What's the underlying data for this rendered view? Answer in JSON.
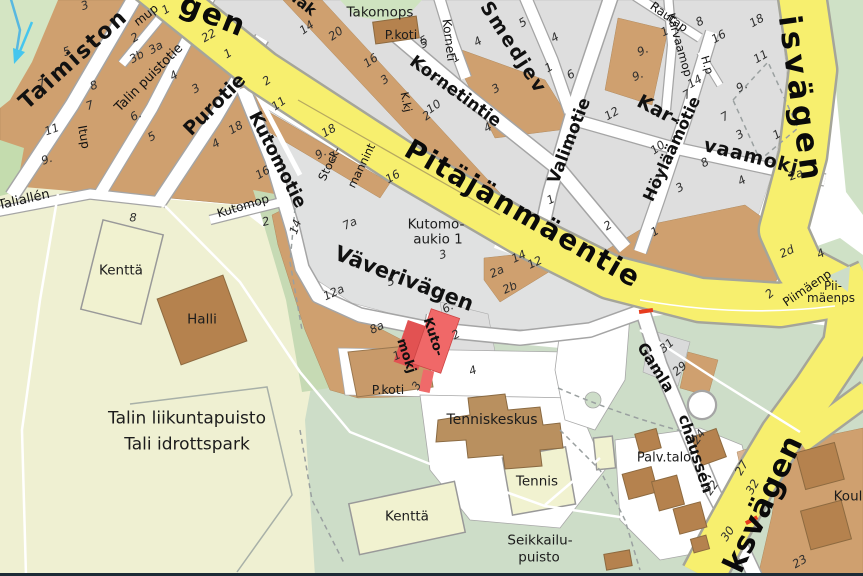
{
  "map": {
    "description": "Street map of Pitajanmaki / Tali area with highlighted street",
    "highlight": {
      "street": "Kutomokj",
      "lines": [
        "Kuto-",
        "mokj"
      ],
      "color": "#ef6363"
    },
    "colors": {
      "main_road_yellow": "#f7ef6e",
      "road_casing": "#a5a5a5",
      "block_tan": "#cfa06f",
      "block_gray": "#dedede",
      "building_brown": "#b5824e",
      "park_pale": "#eff0d2",
      "park_green": "#cdddc8",
      "park_nw": "#d4e5c3",
      "field_fill": "#f1f2d0",
      "highlight_red": "#ef6363",
      "road_mark_red": "#e73c1e",
      "water_blue": "#58b8e0"
    },
    "labels": [
      {
        "k": "road",
        "n": "road-label-fragment-gen",
        "t": "gen",
        "x": 213,
        "y": 16,
        "r": 22,
        "s": 30,
        "ls": 2
      },
      {
        "k": "road",
        "n": "road-label-pitajanmaentie",
        "t": "Pitäjänmäentie",
        "x": 523,
        "y": 214,
        "r": 30,
        "s": 28,
        "ls": 2
      },
      {
        "k": "road",
        "n": "road-label-isvagen",
        "t": "isvägen",
        "x": 800,
        "y": 100,
        "r": 82,
        "s": 31,
        "ls": 5
      },
      {
        "k": "road",
        "n": "road-label-ksvagen",
        "t": "ksvägen",
        "x": 764,
        "y": 504,
        "r": -65,
        "s": 30,
        "ls": 1
      },
      {
        "k": "street",
        "n": "street-label-taimiston",
        "t": "Taimiston",
        "x": 74,
        "y": 60,
        "r": -42,
        "s": 22,
        "ls": 2
      },
      {
        "k": "path",
        "n": "street-label-talin-puistotie",
        "t": "Talin puistotie",
        "x": 149,
        "y": 78,
        "r": -45,
        "s": 13
      },
      {
        "k": "street",
        "n": "street-label-purotie",
        "t": "Purotie",
        "x": 215,
        "y": 105,
        "r": -45,
        "s": 19
      },
      {
        "k": "street",
        "n": "street-label-kutomotie",
        "t": "Kutomotie",
        "x": 277,
        "y": 160,
        "r": 63,
        "s": 18
      },
      {
        "k": "street",
        "n": "street-label-vaverivagen",
        "t": "Väverivägen",
        "x": 404,
        "y": 279,
        "r": 21,
        "s": 21
      },
      {
        "k": "street",
        "n": "street-label-kornetintie",
        "t": "Kornetintie",
        "x": 455,
        "y": 92,
        "r": 36,
        "s": 17
      },
      {
        "k": "path",
        "n": "street-label-korneti-fragment",
        "t": "Korneti",
        "x": 449,
        "y": 40,
        "r": 83,
        "s": 12
      },
      {
        "k": "street",
        "n": "street-label-smedjev",
        "t": "Smedjev",
        "x": 513,
        "y": 48,
        "r": 57,
        "s": 19,
        "ls": 2
      },
      {
        "k": "street",
        "n": "street-label-valimotie",
        "t": "Valimotie",
        "x": 570,
        "y": 141,
        "r": -69,
        "s": 17
      },
      {
        "k": "street",
        "n": "street-label-kar",
        "t": "Kar-",
        "x": 658,
        "y": 111,
        "r": 28,
        "s": 19
      },
      {
        "k": "street",
        "n": "street-label-vaamokj",
        "t": "vaamokj",
        "x": 751,
        "y": 157,
        "r": 14,
        "s": 19,
        "ls": 1
      },
      {
        "k": "path",
        "n": "street-label-karvaamop",
        "t": "Karvaamop",
        "x": 679,
        "y": 45,
        "r": 74,
        "s": 11.5
      },
      {
        "k": "path",
        "n": "street-label-rautap",
        "t": "Rautap",
        "x": 669,
        "y": 17,
        "r": 35,
        "s": 12
      },
      {
        "k": "street",
        "n": "street-label-hoylaamotie",
        "t": "Höyläämötie",
        "x": 672,
        "y": 149,
        "r": -65,
        "s": 16
      },
      {
        "k": "path",
        "n": "street-label-hp",
        "t": "H.p",
        "x": 707,
        "y": 65,
        "r": 73,
        "s": 11
      },
      {
        "k": "path",
        "n": "street-label-kkj",
        "t": "K.kj",
        "x": 406,
        "y": 102,
        "r": 78,
        "s": 11
      },
      {
        "k": "path",
        "n": "street-label-mup",
        "t": "mup",
        "x": 146,
        "y": 15,
        "r": -38,
        "s": 12
      },
      {
        "k": "path",
        "n": "street-label-itup",
        "t": "Itup",
        "x": 84,
        "y": 137,
        "r": 80,
        "s": 12
      },
      {
        "k": "path",
        "n": "street-label-taliallen",
        "t": "Taliallén",
        "x": 24,
        "y": 200,
        "r": -13,
        "s": 13
      },
      {
        "k": "path",
        "n": "street-label-kutomop",
        "t": "Kutomop",
        "x": 243,
        "y": 206,
        "r": -17,
        "s": 12
      },
      {
        "k": "path",
        "n": "street-label-stockmannint-1",
        "t": "Stock-",
        "x": 330,
        "y": 164,
        "r": -64,
        "s": 11.5
      },
      {
        "k": "path",
        "n": "street-label-stockmannint-2",
        "t": "mannint",
        "x": 362,
        "y": 166,
        "r": -64,
        "s": 11.5
      },
      {
        "k": "street",
        "n": "street-label-tak-fragment",
        "t": "Tak",
        "x": 303,
        "y": 4,
        "r": 38,
        "s": 15
      },
      {
        "k": "street",
        "n": "street-label-gamla",
        "t": "Gamla",
        "x": 655,
        "y": 368,
        "r": 58,
        "s": 15.5
      },
      {
        "k": "street",
        "n": "street-label-chaussen",
        "t": "chaussén",
        "x": 695,
        "y": 454,
        "r": 72,
        "s": 15.5
      },
      {
        "k": "path",
        "n": "street-label-piimaenp",
        "t": "Piimäenp",
        "x": 807,
        "y": 288,
        "r": -34,
        "s": 12
      },
      {
        "k": "place",
        "n": "place-label-piimaenps-1",
        "t": "Pii-",
        "x": 833,
        "y": 286,
        "s": 12
      },
      {
        "k": "place",
        "n": "place-label-piimaenps-2",
        "t": "mäenps",
        "x": 831,
        "y": 298,
        "s": 12
      },
      {
        "k": "street",
        "n": "highlighted-street-label-kuto",
        "t": "Kuto-",
        "x": 433,
        "y": 337,
        "r": 72,
        "s": 13
      },
      {
        "k": "street",
        "n": "highlighted-street-label-mokj",
        "t": "mokj",
        "x": 406,
        "y": 356,
        "r": 72,
        "s": 13
      },
      {
        "k": "place",
        "n": "place-label-takomops",
        "t": "Takomops",
        "x": 380,
        "y": 13,
        "s": 13.5
      },
      {
        "k": "place",
        "n": "place-label-pkoti-north",
        "t": "P.koti",
        "x": 401,
        "y": 35,
        "s": 12.5
      },
      {
        "k": "place",
        "n": "place-label-kutomoaukio-1",
        "t": "Kutomo-",
        "x": 436,
        "y": 225,
        "s": 13.5
      },
      {
        "k": "place",
        "n": "place-label-kutomoaukio-2",
        "t": "aukio 1",
        "x": 438,
        "y": 240,
        "s": 13.5
      },
      {
        "k": "place",
        "n": "place-label-kentta-north",
        "t": "Kenttä",
        "x": 121,
        "y": 271,
        "s": 13.5
      },
      {
        "k": "place",
        "n": "place-label-halli",
        "t": "Halli",
        "x": 202,
        "y": 320,
        "s": 13.5
      },
      {
        "k": "place",
        "n": "place-label-talin-liikuntapuisto",
        "t": "Talin liikuntapuisto",
        "x": 187,
        "y": 419,
        "s": 17
      },
      {
        "k": "place",
        "n": "place-label-tali-idrottspark",
        "t": "Tali idrottspark",
        "x": 187,
        "y": 445,
        "s": 17
      },
      {
        "k": "place",
        "n": "place-label-pkoti-south",
        "t": "P.koti",
        "x": 388,
        "y": 390,
        "s": 12.5
      },
      {
        "k": "place",
        "n": "place-label-tenniskeskus",
        "t": "Tenniskeskus",
        "x": 492,
        "y": 420,
        "s": 14
      },
      {
        "k": "place",
        "n": "place-label-tennis",
        "t": "Tennis",
        "x": 537,
        "y": 482,
        "s": 13.5
      },
      {
        "k": "place",
        "n": "place-label-kentta-south",
        "t": "Kenttä",
        "x": 407,
        "y": 517,
        "s": 13.5
      },
      {
        "k": "place",
        "n": "place-label-seikkailupuisto-1",
        "t": "Seikkailu-",
        "x": 540,
        "y": 541,
        "s": 13.5
      },
      {
        "k": "place",
        "n": "place-label-seikkailupuisto-2",
        "t": "puisto",
        "x": 539,
        "y": 558,
        "s": 13.5
      },
      {
        "k": "place",
        "n": "place-label-palvtalo",
        "t": "Palv.talo",
        "x": 664,
        "y": 458,
        "s": 13
      },
      {
        "k": "place",
        "n": "place-label-koulu",
        "t": "Koul",
        "x": 848,
        "y": 497,
        "s": 13.5
      },
      {
        "k": "num",
        "t": "3",
        "x": 85,
        "y": 6,
        "r": -20
      },
      {
        "k": "num",
        "t": "5",
        "x": 67,
        "y": 52,
        "r": -20
      },
      {
        "k": "num",
        "t": "7",
        "x": 42,
        "y": 84,
        "r": -25
      },
      {
        "k": "num",
        "t": "8",
        "x": 94,
        "y": 86,
        "r": -20
      },
      {
        "k": "num",
        "t": "7",
        "x": 90,
        "y": 106,
        "r": -20
      },
      {
        "k": "num",
        "t": "11",
        "x": 52,
        "y": 130,
        "r": -20
      },
      {
        "k": "num",
        "t": "9.",
        "x": 47,
        "y": 160,
        "r": -20
      },
      {
        "k": "num",
        "t": "2",
        "x": 135,
        "y": 38,
        "r": -30
      },
      {
        "k": "num",
        "t": "3b",
        "x": 137,
        "y": 57,
        "r": -30
      },
      {
        "k": "num",
        "t": "3a",
        "x": 156,
        "y": 48,
        "r": -30
      },
      {
        "k": "num",
        "t": "1",
        "x": 166,
        "y": 10,
        "r": -30
      },
      {
        "k": "num",
        "t": "4",
        "x": 174,
        "y": 76,
        "r": -30
      },
      {
        "k": "num",
        "t": "3",
        "x": 196,
        "y": 89,
        "r": -30
      },
      {
        "k": "num",
        "t": "6.",
        "x": 136,
        "y": 116,
        "r": -30
      },
      {
        "k": "num",
        "t": "5",
        "x": 152,
        "y": 137,
        "r": -30
      },
      {
        "k": "num",
        "t": "22",
        "x": 209,
        "y": 36,
        "r": -30
      },
      {
        "k": "num",
        "t": "1",
        "x": 228,
        "y": 54,
        "r": -30
      },
      {
        "k": "num",
        "t": "2",
        "x": 267,
        "y": 81,
        "r": -35
      },
      {
        "k": "num",
        "t": "11",
        "x": 279,
        "y": 104,
        "r": -35
      },
      {
        "k": "num",
        "t": "18",
        "x": 236,
        "y": 128,
        "r": -30
      },
      {
        "k": "num",
        "t": "4",
        "x": 216,
        "y": 144,
        "r": -30
      },
      {
        "k": "num",
        "t": "16",
        "x": 263,
        "y": 173,
        "r": -30
      },
      {
        "k": "num",
        "t": "8",
        "x": 133,
        "y": 218
      },
      {
        "k": "num",
        "t": "2",
        "x": 266,
        "y": 222,
        "r": -15
      },
      {
        "k": "num",
        "t": "14",
        "x": 307,
        "y": 28,
        "r": -35
      },
      {
        "k": "num",
        "t": "20",
        "x": 336,
        "y": 34,
        "r": -35
      },
      {
        "k": "num",
        "t": "16",
        "x": 371,
        "y": 61,
        "r": -35
      },
      {
        "k": "num",
        "t": "3",
        "x": 385,
        "y": 80,
        "r": -35
      },
      {
        "k": "num",
        "t": "18",
        "x": 329,
        "y": 131,
        "r": -30
      },
      {
        "k": "num",
        "t": "9.",
        "x": 321,
        "y": 154,
        "r": -30
      },
      {
        "k": "num",
        "t": "2",
        "x": 333,
        "y": 157,
        "r": -30
      },
      {
        "k": "num",
        "t": "16",
        "x": 393,
        "y": 177,
        "r": -30
      },
      {
        "k": "num",
        "t": "5",
        "x": 424,
        "y": 44,
        "r": -30
      },
      {
        "k": "num",
        "t": "1",
        "x": 456,
        "y": 58,
        "r": -30
      },
      {
        "k": "num",
        "t": "4",
        "x": 478,
        "y": 42,
        "r": -30
      },
      {
        "k": "num",
        "t": "5",
        "x": 523,
        "y": 23,
        "r": -30
      },
      {
        "k": "num",
        "t": "4",
        "x": 555,
        "y": 38,
        "r": -30
      },
      {
        "k": "num",
        "t": "1",
        "x": 549,
        "y": 68,
        "r": -30
      },
      {
        "k": "num",
        "t": "6",
        "x": 571,
        "y": 75,
        "r": -30
      },
      {
        "k": "num",
        "t": "3",
        "x": 496,
        "y": 89,
        "r": -30
      },
      {
        "k": "num",
        "t": "4",
        "x": 488,
        "y": 128,
        "r": -30
      },
      {
        "k": "num",
        "t": "10",
        "x": 434,
        "y": 107,
        "r": -35
      },
      {
        "k": "num",
        "t": "2",
        "x": 427,
        "y": 116,
        "r": -35
      },
      {
        "k": "num",
        "t": "12",
        "x": 612,
        "y": 114,
        "r": -30
      },
      {
        "k": "num",
        "t": "10",
        "x": 658,
        "y": 148,
        "r": -35
      },
      {
        "k": "num",
        "t": "9.",
        "x": 643,
        "y": 51,
        "r": -25
      },
      {
        "k": "num",
        "t": "9.",
        "x": 638,
        "y": 76,
        "r": -25
      },
      {
        "k": "num",
        "t": "1",
        "x": 665,
        "y": 32,
        "r": -25
      },
      {
        "k": "num",
        "t": "8",
        "x": 700,
        "y": 22,
        "r": -30
      },
      {
        "k": "num",
        "t": "16",
        "x": 719,
        "y": 37,
        "r": -30
      },
      {
        "k": "num",
        "t": "18",
        "x": 757,
        "y": 21,
        "r": -30
      },
      {
        "k": "num",
        "t": "11",
        "x": 761,
        "y": 57,
        "r": -30
      },
      {
        "k": "num",
        "t": "9.",
        "x": 742,
        "y": 87,
        "r": -30
      },
      {
        "k": "num",
        "t": "14",
        "x": 695,
        "y": 82,
        "r": -30
      },
      {
        "k": "num",
        "t": "7",
        "x": 687,
        "y": 95,
        "r": -30
      },
      {
        "k": "num",
        "t": "7",
        "x": 725,
        "y": 117,
        "r": -30
      },
      {
        "k": "num",
        "t": "3",
        "x": 740,
        "y": 135,
        "r": -30
      },
      {
        "k": "num",
        "t": "1",
        "x": 777,
        "y": 135,
        "r": -30
      },
      {
        "k": "num",
        "t": "8",
        "x": 705,
        "y": 163,
        "r": -30
      },
      {
        "k": "num",
        "t": "3",
        "x": 680,
        "y": 188,
        "r": -30
      },
      {
        "k": "num",
        "t": "4",
        "x": 742,
        "y": 181,
        "r": -30
      },
      {
        "k": "num",
        "t": "2a",
        "x": 796,
        "y": 175,
        "r": -20
      },
      {
        "k": "num",
        "t": "2",
        "x": 608,
        "y": 226,
        "r": -30
      },
      {
        "k": "num",
        "t": "1",
        "x": 655,
        "y": 232,
        "r": -30
      },
      {
        "k": "num",
        "t": "7a",
        "x": 350,
        "y": 224,
        "r": -25
      },
      {
        "k": "num",
        "t": "5",
        "x": 391,
        "y": 282,
        "r": -15
      },
      {
        "k": "num",
        "t": "3",
        "x": 443,
        "y": 255,
        "r": -15
      },
      {
        "k": "num",
        "t": "1",
        "x": 551,
        "y": 200,
        "r": -25
      },
      {
        "k": "num",
        "t": "2a",
        "x": 497,
        "y": 272,
        "r": -25
      },
      {
        "k": "num",
        "t": "2b",
        "x": 510,
        "y": 288,
        "r": -25
      },
      {
        "k": "num",
        "t": "14",
        "x": 519,
        "y": 257,
        "r": -25
      },
      {
        "k": "num",
        "t": "12",
        "x": 535,
        "y": 263,
        "r": -25
      },
      {
        "k": "num",
        "t": "12a",
        "x": 334,
        "y": 293,
        "r": -25
      },
      {
        "k": "num",
        "t": "8a",
        "x": 377,
        "y": 328,
        "r": -25
      },
      {
        "k": "num",
        "t": "14",
        "x": 296,
        "y": 227,
        "r": -70
      },
      {
        "k": "num",
        "t": "1",
        "x": 397,
        "y": 356,
        "r": -25
      },
      {
        "k": "num",
        "t": "6.",
        "x": 448,
        "y": 308,
        "r": -30
      },
      {
        "k": "num",
        "t": "2",
        "x": 456,
        "y": 335,
        "r": -30
      },
      {
        "k": "num",
        "t": "4",
        "x": 473,
        "y": 371,
        "r": -20
      },
      {
        "k": "num",
        "t": "3",
        "x": 417,
        "y": 386,
        "r": -60
      },
      {
        "k": "num",
        "t": "2d",
        "x": 787,
        "y": 252,
        "r": -25
      },
      {
        "k": "num",
        "t": "4",
        "x": 821,
        "y": 254,
        "r": -25
      },
      {
        "k": "num",
        "t": "2",
        "x": 770,
        "y": 294,
        "r": -40
      },
      {
        "k": "num",
        "t": "31",
        "x": 667,
        "y": 346,
        "r": -40
      },
      {
        "k": "num",
        "t": "29",
        "x": 680,
        "y": 369,
        "r": -40
      },
      {
        "k": "num",
        "t": "24",
        "x": 699,
        "y": 437,
        "r": -55
      },
      {
        "k": "num",
        "t": "22",
        "x": 712,
        "y": 488,
        "r": -55
      },
      {
        "k": "num",
        "t": "27",
        "x": 742,
        "y": 468,
        "r": -60
      },
      {
        "k": "num",
        "t": "32",
        "x": 753,
        "y": 487,
        "r": -60
      },
      {
        "k": "num",
        "t": "30",
        "x": 728,
        "y": 534,
        "r": -55
      },
      {
        "k": "num",
        "t": "23",
        "x": 800,
        "y": 562,
        "r": -30
      },
      {
        "k": "num",
        "t": "5",
        "x": 424,
        "y": 41,
        "r": -30
      }
    ]
  }
}
